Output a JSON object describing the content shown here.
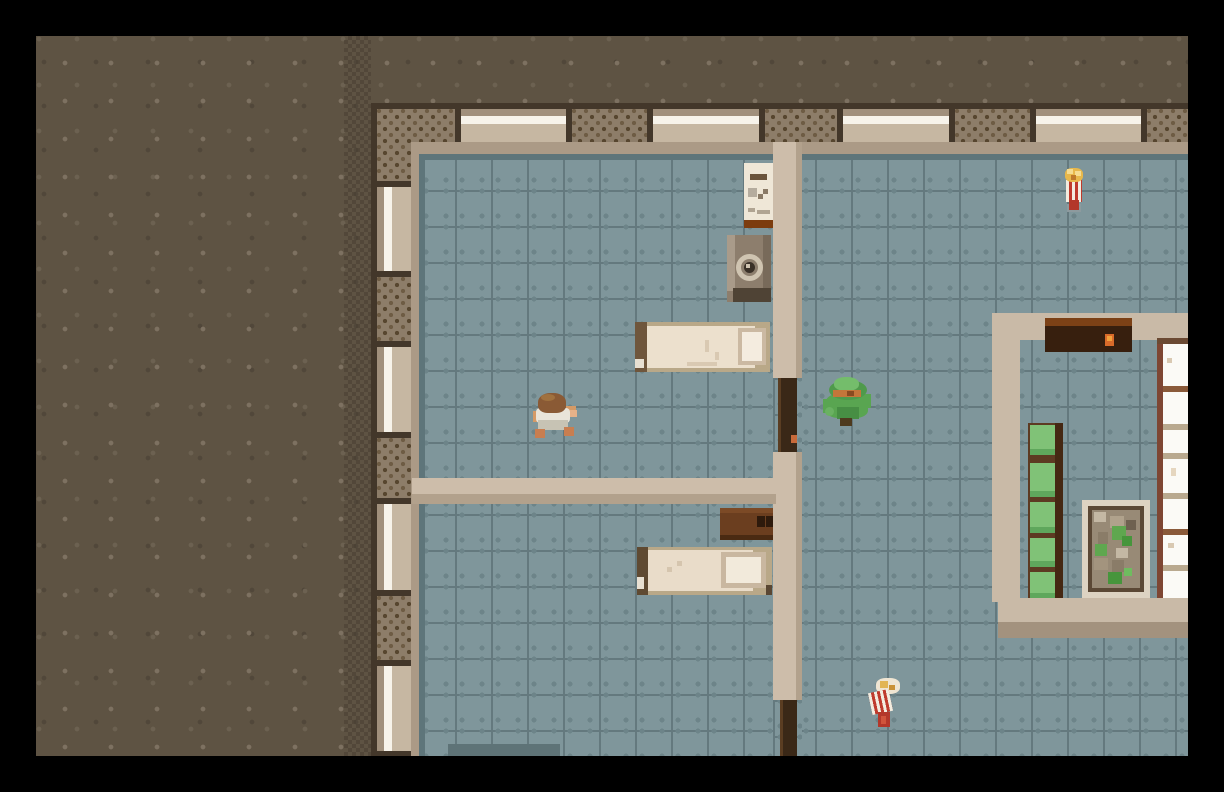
{
  "scene": {
    "name": "top-down pixel-art survival game",
    "view": "overhead view of a building interior with two bedrooms, a hallway and a small stockroom, surrounded by dark dirt ground and a black letterbox border",
    "visible_text": "none"
  },
  "palette": {
    "border_black": "#000000",
    "dirt_ground": "#5e5343",
    "dirt_speckle": "#7d7161",
    "exterior_wall_tan": "#a1907c",
    "exterior_wall_brick": "#8d7d69",
    "wall_dark_edge": "#43372a",
    "window_white": "#f7f3ea",
    "window_sill": "#c6b7a2",
    "floor_tile_blue": "#7f969b",
    "floor_grout": "#64797e",
    "interior_wall_light": "#cdbdaa",
    "interior_wall_shade": "#b2a18c",
    "door_wood_dark": "#3a2817",
    "door_handle_orange": "#c96a3a",
    "bed_mattress": "#ece0cd",
    "bed_headboard": "#6f563c",
    "dresser_wood": "#6b3e1f",
    "shelf_green": "#80c277",
    "shelf_frame_brown": "#5d3a22",
    "white_shelf": "#fbfaf6",
    "counter_dark": "#371f0e",
    "flame_orange": "#d96b2a",
    "popcorn_red": "#bf3a2c",
    "popcorn_yellow": "#e8b84b",
    "figure_green": "#59a551",
    "hat_band_orange": "#c4763a",
    "player_hair_brown": "#8a5a35",
    "player_shirt_white": "#e9e4d9",
    "skin": "#d59a66"
  },
  "entities": {
    "player": {
      "name": "Player character (brown hair, white shirt)",
      "x": 533,
      "y": 393
    },
    "green_figure": {
      "name": "Figure in green hat and green suit",
      "x": 823,
      "y": 377
    },
    "popcorn_upright": {
      "name": "Popcorn box item (upright)",
      "x": 1063,
      "y": 167
    },
    "popcorn_spilled": {
      "name": "Popcorn box item (spilled)",
      "x": 868,
      "y": 678
    }
  },
  "furniture": {
    "noticeboard": {
      "name": "Notice board on wall"
    },
    "washer": {
      "name": "Washing machine"
    },
    "bed_top": {
      "name": "Single bed with pillow (upper bedroom)"
    },
    "bed_bottom": {
      "name": "Single bed with pillow (lower bedroom)"
    },
    "dresser": {
      "name": "Wooden dresser with handles"
    },
    "counter": {
      "name": "Dark counter with lit burner"
    },
    "green_shelf": {
      "name": "Green shelving unit"
    },
    "stone_planter": {
      "name": "Planter box with stones and plants"
    },
    "white_shelf": {
      "name": "White display shelf"
    },
    "door_upper": {
      "name": "Open doorway (upper)"
    },
    "door_lower": {
      "name": "Open doorway (lower)"
    }
  }
}
